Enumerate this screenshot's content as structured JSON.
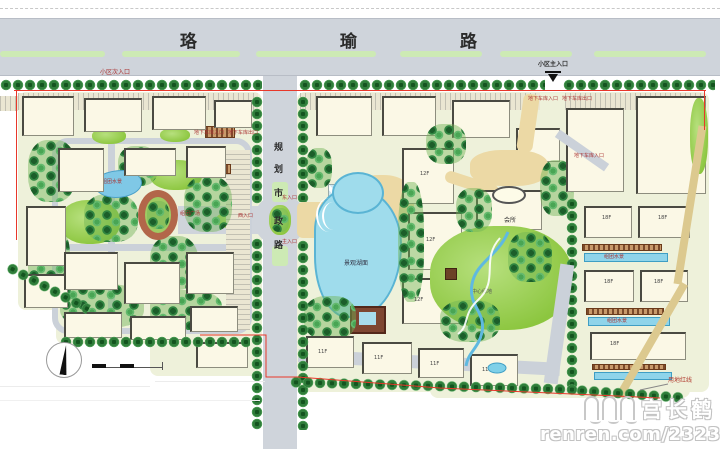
{
  "roads": {
    "top": {
      "name": "珞瑜路",
      "chars": [
        "珞",
        "瑜",
        "路"
      ]
    },
    "vertical": {
      "name": "规划市政路",
      "chars": [
        "规",
        "划",
        "市",
        "政",
        "路"
      ]
    }
  },
  "entrances": {
    "main": "小区主入口",
    "secondary": "小区次入口",
    "east": "东入口",
    "west": "西入口",
    "inner_main": "主入口",
    "garage_in": "地下车库入口",
    "garage_out": "地下车库出口"
  },
  "features": {
    "lake": "景观湖面",
    "clubhouse": "会所",
    "cluster_plaza": "组团广场",
    "cluster_pond": "组团水景",
    "linear_pool": "组团水景",
    "central_green": "中心绿地",
    "site_boundary": "用地红线"
  },
  "floors": {
    "f11": "11F",
    "f12": "12F",
    "f18": "18F"
  },
  "watermark": {
    "brand": "宫长鹤",
    "url": "renren.com/232333316"
  },
  "colors": {
    "road": "#cfd4db",
    "grass": "#8cc63f",
    "tree": "#2f7d3a",
    "water": "#8fd4ea",
    "building": "#fbf8e6",
    "boundary": "#e8382a",
    "plaza": "#ecd9a5"
  }
}
